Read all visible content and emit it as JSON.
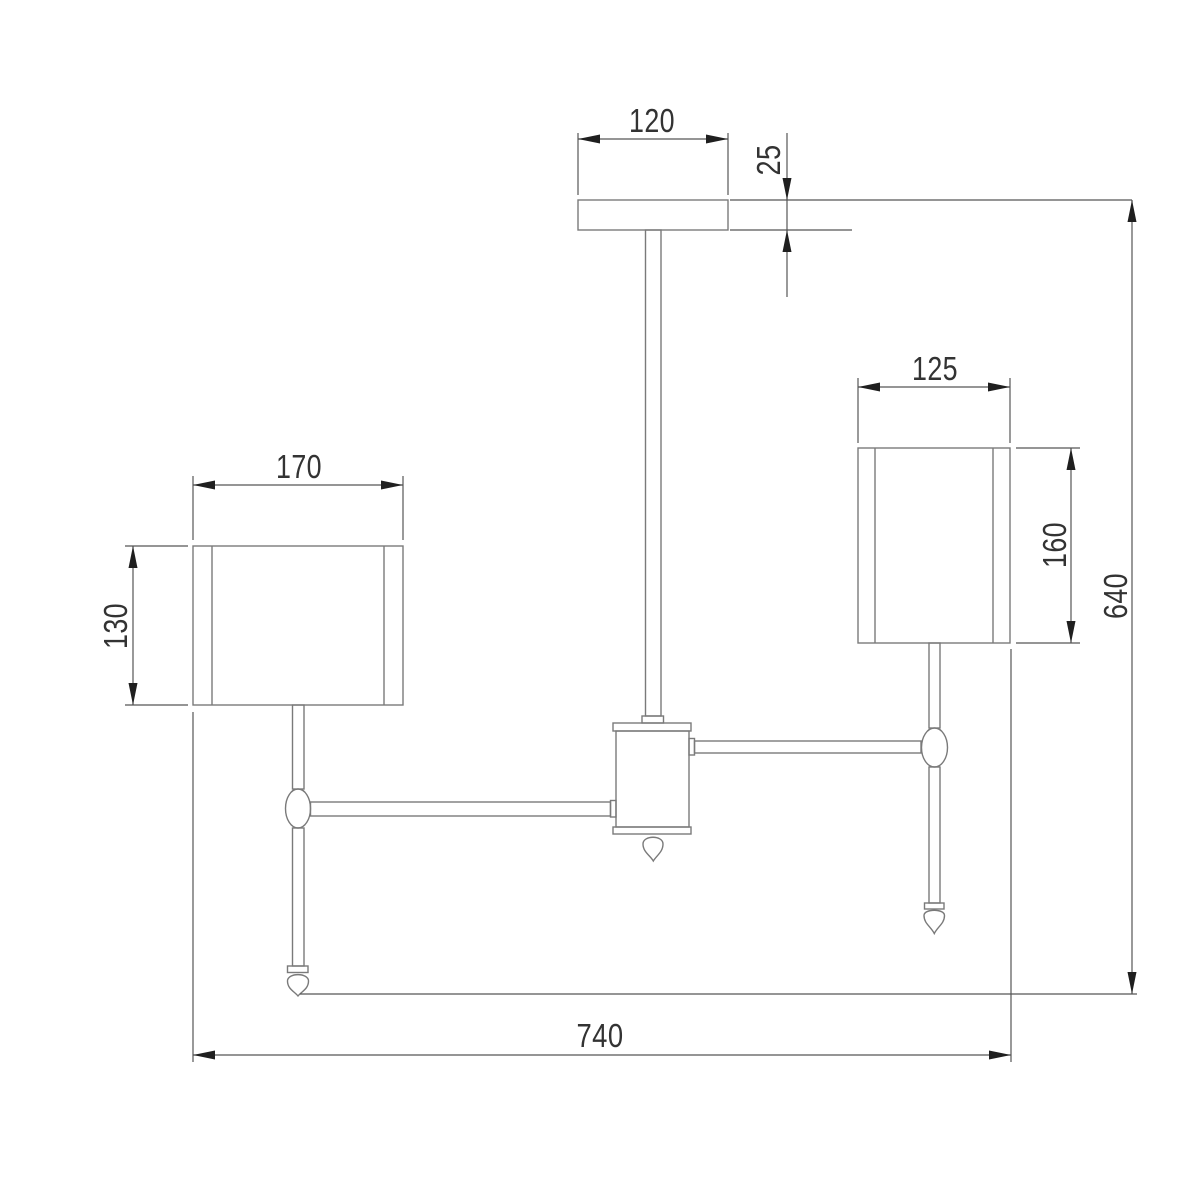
{
  "diagram": {
    "type": "technical-drawing",
    "view": "front-elevation",
    "dimensions": {
      "canopy_width": "120",
      "canopy_height": "25",
      "left_shade_width": "170",
      "left_shade_height": "130",
      "right_shade_width": "125",
      "right_shade_height": "160",
      "overall_height": "640",
      "overall_width": "740"
    },
    "colors": {
      "background": "#ffffff",
      "fixture_line": "#7a7a7a",
      "dimension_line": "#565656",
      "arrow": "#1f1f1f",
      "label_text": "#333333"
    }
  }
}
